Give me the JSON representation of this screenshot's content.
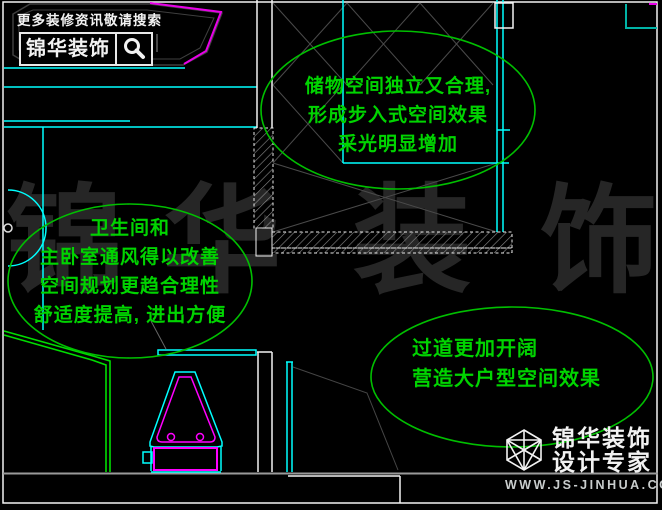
{
  "promo_header": {
    "search_hint": "更多装修资讯敬请搜索",
    "brand": "锦华装饰",
    "search_icon": "magnifier-icon"
  },
  "annotations": {
    "closet": {
      "lines": [
        "储物空间独立又合理,",
        "形成步入式空间效果",
        "采光明显增加"
      ]
    },
    "bathroom": {
      "lines": [
        "卫生间和",
        "主卧室通风得以改善",
        "空间规划更趋合理性",
        "舒适度提高, 进出方便"
      ]
    },
    "hallway": {
      "lines": [
        "过道更加开阔",
        "营造大户型空间效果"
      ]
    }
  },
  "watermark": {
    "characters": [
      "锦",
      "华",
      "装",
      "饰"
    ]
  },
  "footer_logo": {
    "brand": "锦华装饰",
    "tagline": "设计专家",
    "website": "WWW.JS-JINHUA.COM",
    "logo_icon": "wireframe-cube-icon"
  },
  "colors": {
    "background": "#000000",
    "annotation_green": "#00d400",
    "partition_green": "#00dd00",
    "line_cyan": "#00ffff",
    "corner_teal": "#00b3a6",
    "fixture_magenta": "#ff00ff",
    "wall_white": "#f2f2f2",
    "lattice_gray": "#4a4a4a",
    "tub_gray": "#3f3f3f",
    "divider_gray": "#9a9a9a",
    "watermark_gray": "#262626",
    "url_gray": "#c9cdcd"
  }
}
